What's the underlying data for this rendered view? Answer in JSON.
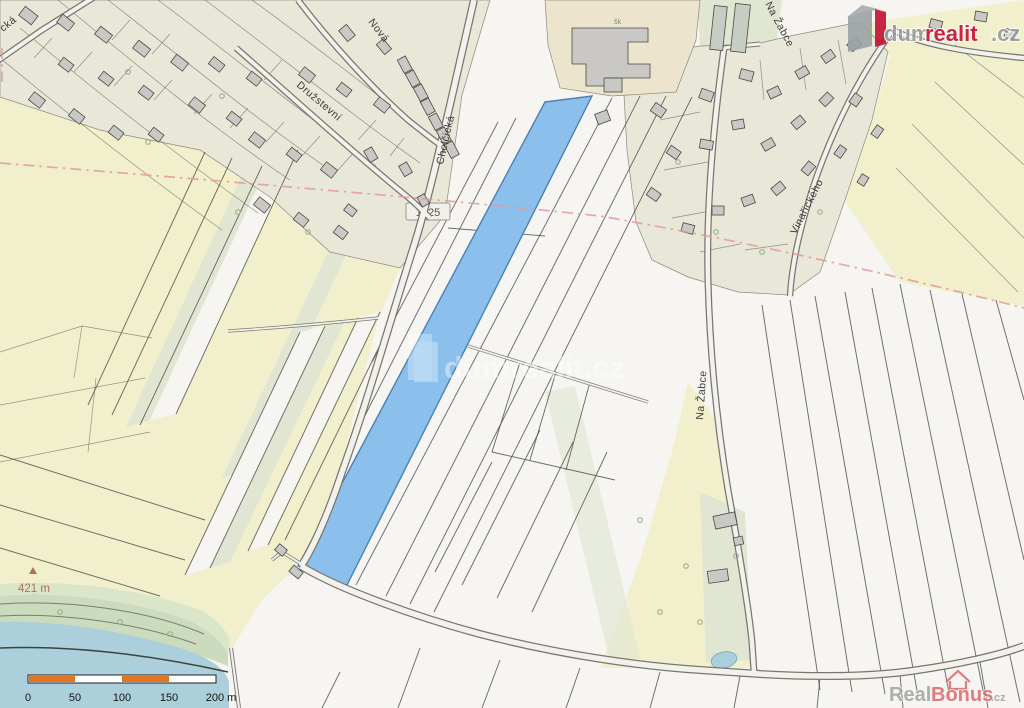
{
  "map": {
    "street_labels": {
      "nova": "Nová",
      "druzstevni": "Družstevní",
      "chelcicka": "Chelčická",
      "na_zabce_top": "Na Žabce",
      "na_zabce_mid": "Na Žabce",
      "vinarickeho": "Vinařického",
      "corner_fragment": "cká"
    },
    "road_number": "1225",
    "school_abbrev": "šk",
    "spot_height": "421 m"
  },
  "scale_bar": {
    "labels": [
      "0",
      "50",
      "100",
      "150",
      "200 m"
    ]
  },
  "watermarks": {
    "center": "dumrealit.cz",
    "logo": {
      "gray_part": "dum",
      "red_part": "realit",
      "suffix": ".cz"
    },
    "corner": {
      "gray_part": "Real",
      "red_part": "Bonus",
      "suffix": ".cz"
    }
  },
  "colors": {
    "parcel_bg": "#f6f5f2",
    "field_yellow": "#f2efcd",
    "field_green": "#e0e6d2",
    "urban_beige": "#e9e7d8",
    "school_tan": "#ece4cd",
    "building_gray": "#c9c8c4",
    "building_outline": "#4a4a44",
    "parcel_line": "#55554d",
    "water_blue": "#abcfdb",
    "shore_green": "#ccdabd",
    "highlight_blue": "#8ac0eb",
    "highlight_border": "#4d80b2",
    "road_fill": "#f3f1ec",
    "road_casing": "#77776e",
    "boundary_red": "#e29a97",
    "scale_orange": "#e0761f",
    "spot_height_brown": "#b4705a",
    "logo_gray": "#94979a",
    "logo_red": "#c20a2e",
    "corner_red": "#dd686c",
    "label_gray": "#3c3c35"
  }
}
